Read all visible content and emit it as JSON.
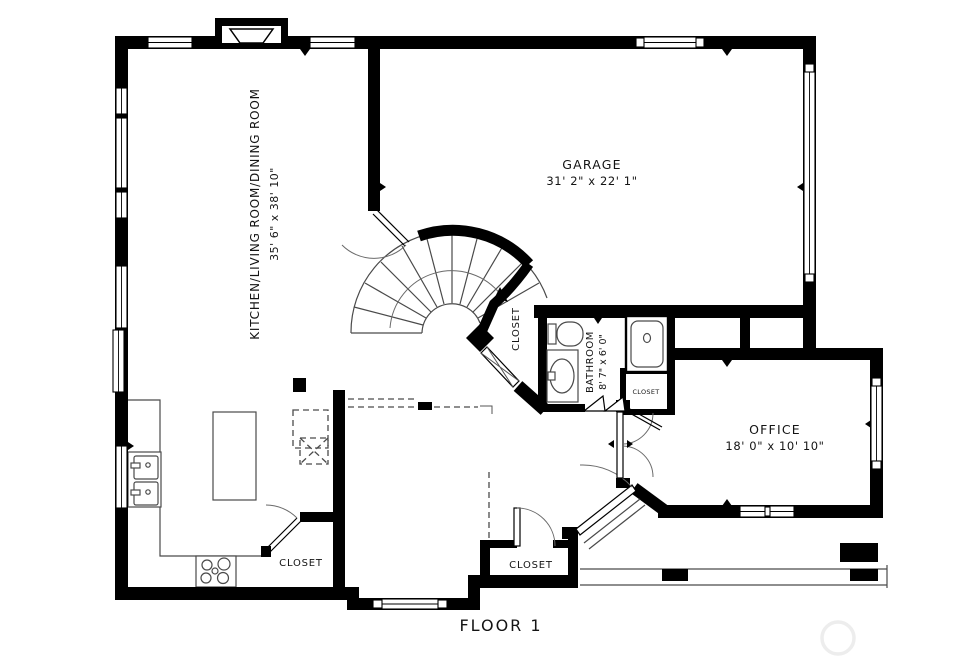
{
  "floor_label": "FLOOR 1",
  "rooms": {
    "living": {
      "name": "KITCHEN/LIVING ROOM/DINING ROOM",
      "dims": "35' 6\" x 38' 10\""
    },
    "garage": {
      "name": "GARAGE",
      "dims": "31' 2\" x 22' 1\""
    },
    "bathroom": {
      "name": "BATHROOM",
      "dims": "8' 7\" x 6' 0\""
    },
    "office": {
      "name": "OFFICE",
      "dims": "18' 0\" x 10' 10\""
    }
  },
  "closets": {
    "under_stair": "CLOSET",
    "bathroom": "CLOSET",
    "kitchen": "CLOSET",
    "entry": "CLOSET"
  },
  "colors": {
    "wall": "#000000",
    "thin_line": "#4a4a4a",
    "background": "#ffffff",
    "watermark_ring": "#ededed"
  },
  "fixtures": [
    "fireplace",
    "spiral-staircase",
    "stove-cooktop",
    "kitchen-island",
    "double-sink",
    "toilet",
    "vanity-sink",
    "shower",
    "front-door",
    "french-doors",
    "porch"
  ]
}
